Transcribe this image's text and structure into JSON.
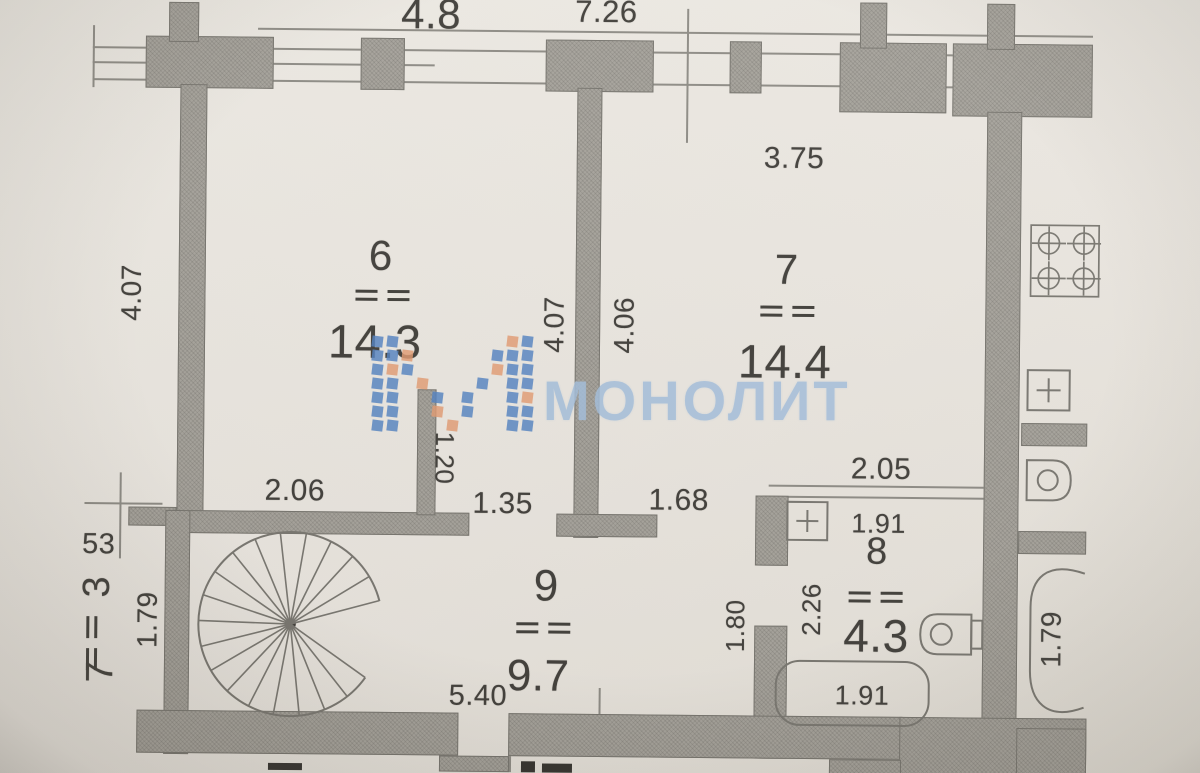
{
  "watermark": {
    "text": "МОНОЛИТ"
  },
  "rooms": {
    "room6": {
      "number": "6",
      "area": "14.3"
    },
    "room7": {
      "number": "7",
      "area": "14.4"
    },
    "room8": {
      "number": "8",
      "area": "4.3"
    },
    "room9": {
      "number": "9",
      "area": "9.7"
    },
    "room3": {
      "number": "3",
      "area": "7"
    }
  },
  "dimensions": {
    "top_segment": "4.8",
    "top_total": "7.26",
    "room7_width": "3.75",
    "room6_left_height": "4.07",
    "room6_right_height": "4.07",
    "room7_left_height": "4.06",
    "stub_length": "1.20",
    "room9_left_width": "2.06",
    "opening_left": "1.35",
    "opening_right": "1.68",
    "room8_top_width": "2.05",
    "room8_inner_width": "1.91",
    "room8_height": "2.26",
    "room9_right_height": "1.80",
    "room9_width": "5.40",
    "bathtub_label": "1.91",
    "balcony_offset": "53",
    "balcony_height": "1.79",
    "right_bath_height": "1.79"
  }
}
